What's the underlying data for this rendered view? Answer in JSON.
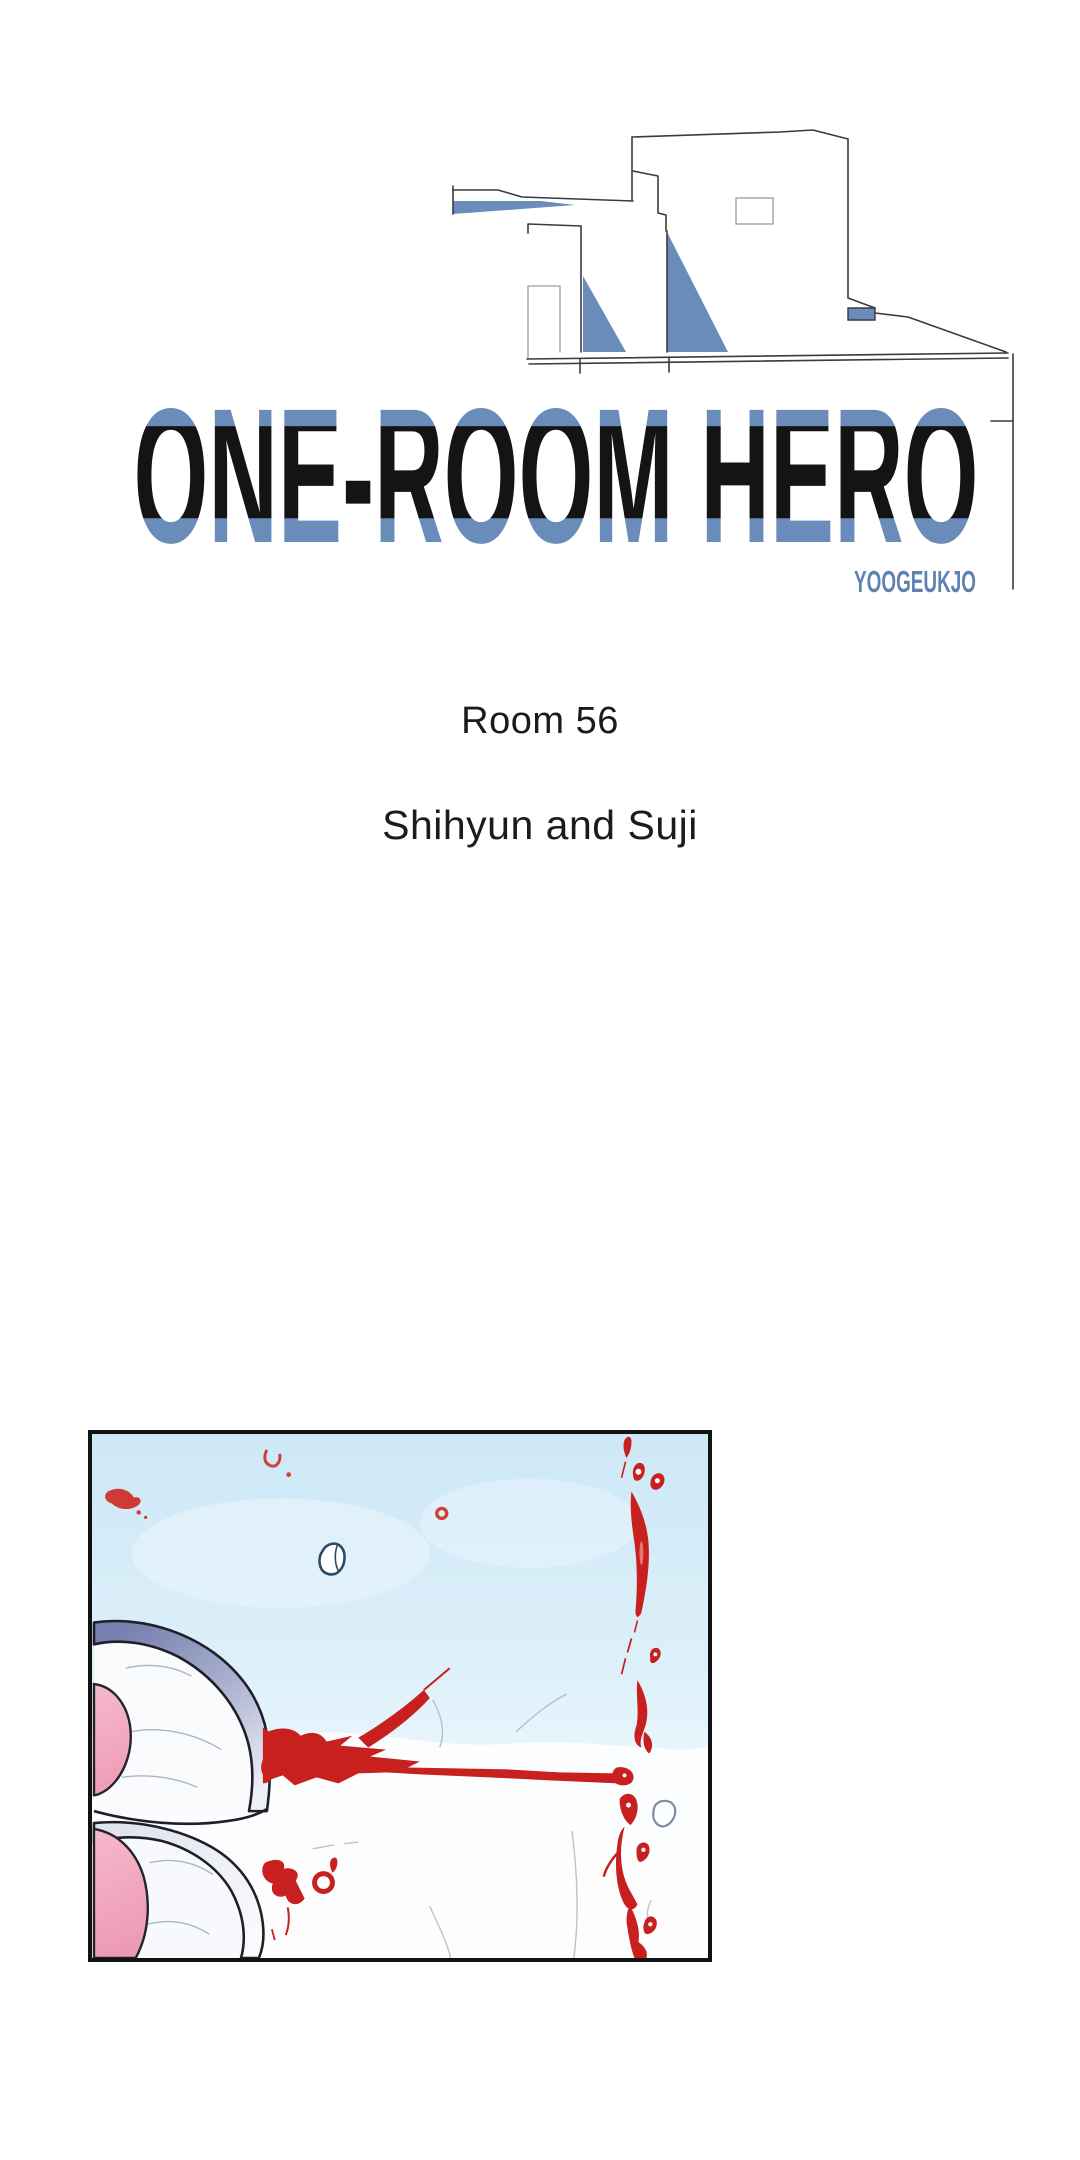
{
  "series": {
    "title": "ONE-ROOM HERO",
    "author": "YOOGEUKJO"
  },
  "chapter": {
    "room": "Room 56",
    "subtitle": "Shihyun and Suji"
  },
  "colors": {
    "accent_blue": "#6a8cba",
    "author_blue": "#5e82b1",
    "title_black": "#141414",
    "panel_border": "#121212",
    "sky_blue": "#cfe9f7",
    "blood_red": "#c81f1f",
    "skin_pink": "#f2a9be",
    "slipper_slate": "#7e86b0",
    "line_art_gray": "#3b3b3b"
  }
}
